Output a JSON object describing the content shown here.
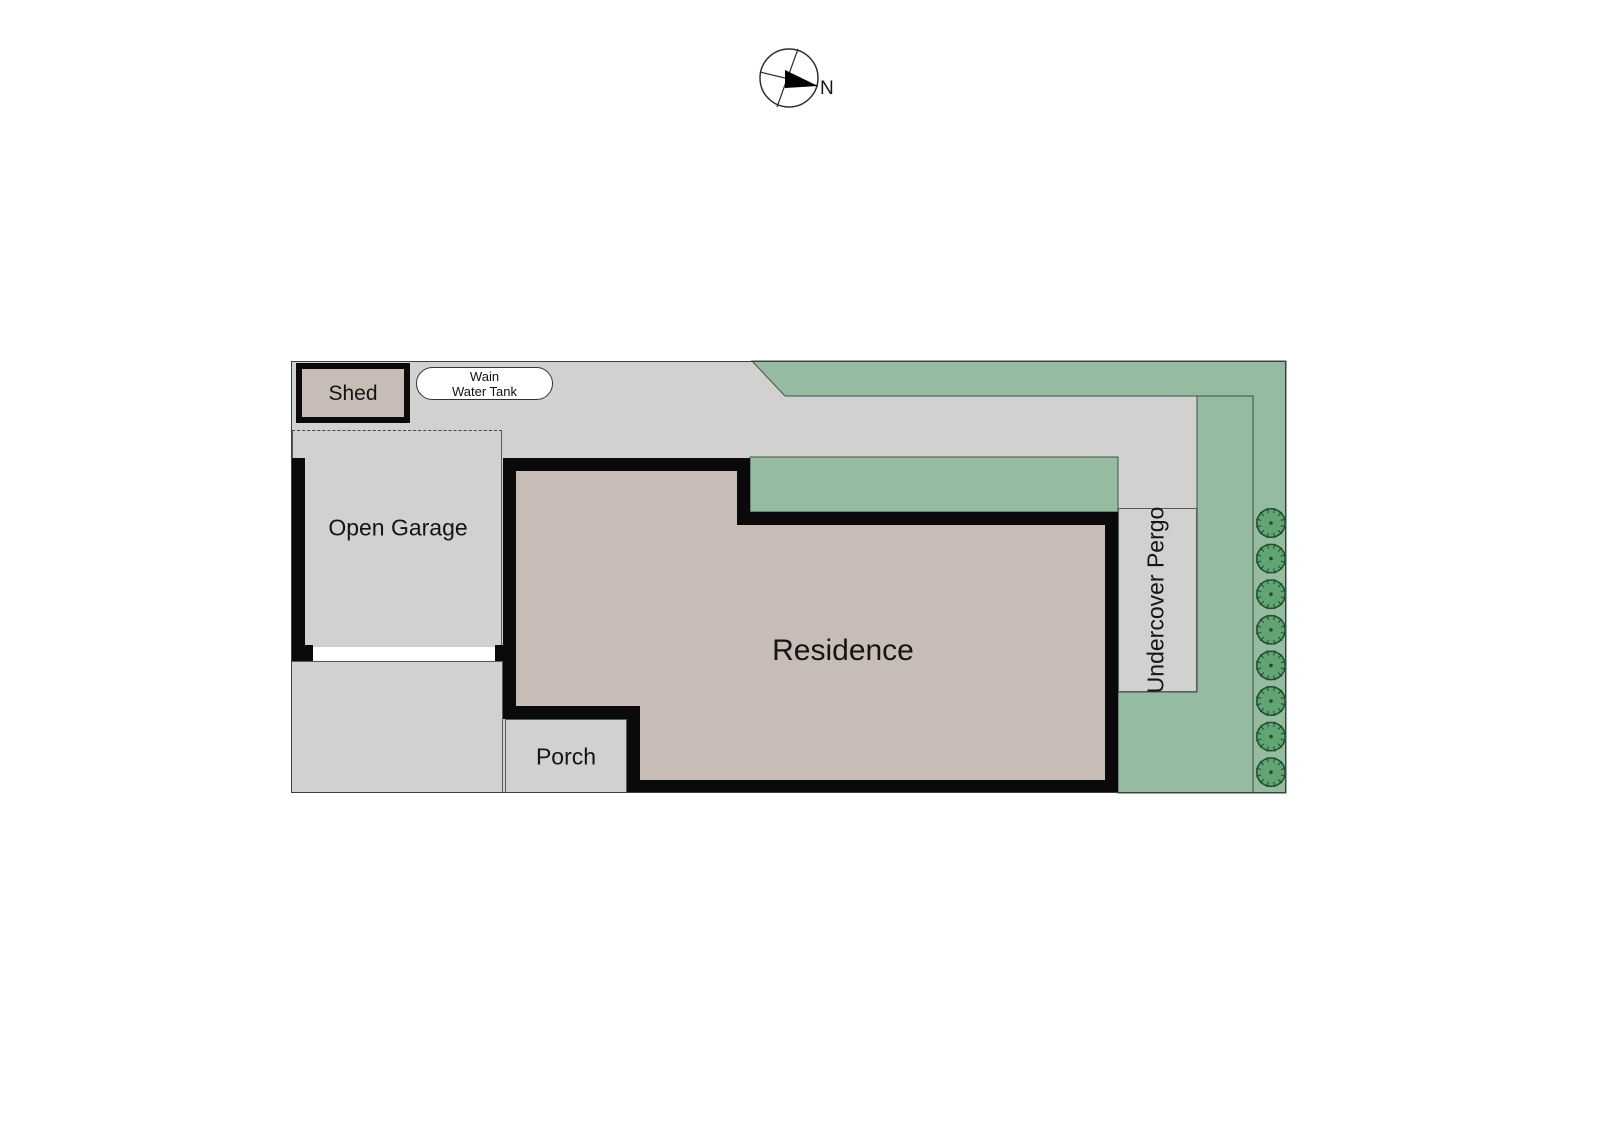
{
  "compass": {
    "north_label": "N"
  },
  "plan": {
    "shed_label": "Shed",
    "water_tank_label_line1": "Wain",
    "water_tank_label_line2": "Water Tank",
    "open_garage_label": "Open Garage",
    "residence_label": "Residence",
    "porch_label": "Porch",
    "pergola_label": "Undercover Pergo",
    "trees": {
      "count": 8
    },
    "colors": {
      "paving": "#d1d1cf",
      "grass": "#95bba1",
      "building": "#c7bdb6",
      "wall": "#0a0a0a",
      "tree_fill": "#62a473",
      "tree_stroke": "#1e4c2d"
    }
  }
}
